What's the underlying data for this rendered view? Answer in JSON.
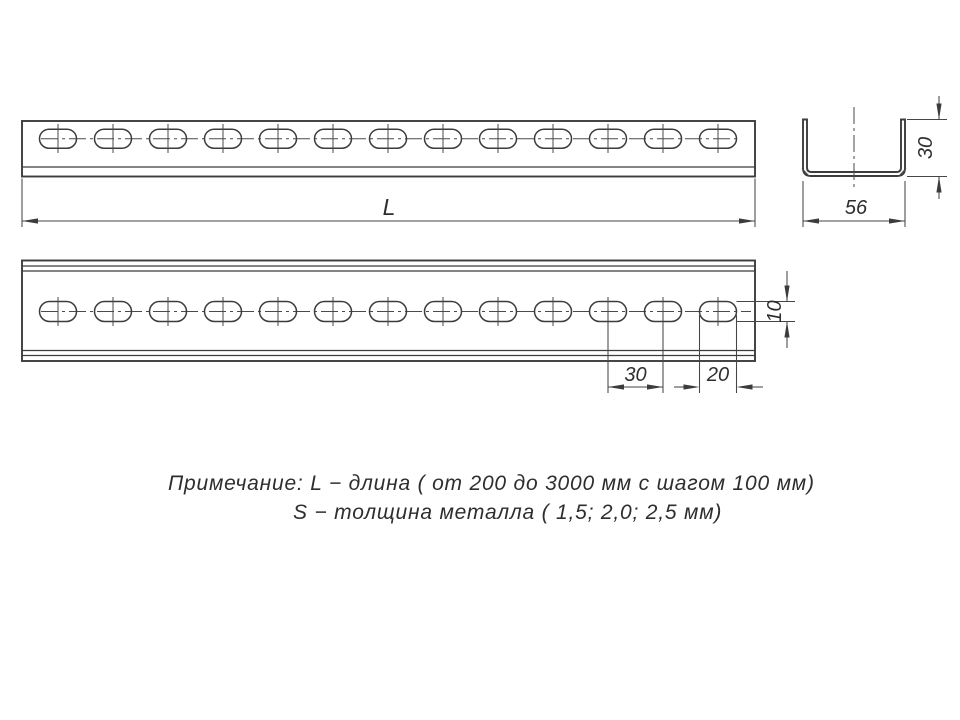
{
  "drawing": {
    "views": {
      "side_view": {
        "length_label": "L"
      },
      "plan_view": {
        "slot_width_label": "10",
        "slot_pitch_label": "30",
        "slot_length_label": "20"
      },
      "section_view": {
        "height_label": "30",
        "width_label": "56"
      }
    },
    "note": {
      "line1": "Примечание: L − длина ( от 200 до 3000 мм с шагом 100 мм)",
      "line2": "S − толщина металла ( 1,5; 2,0; 2,5 мм)"
    },
    "colors": {
      "line": "#3c3c3c",
      "background": "#ffffff"
    }
  }
}
